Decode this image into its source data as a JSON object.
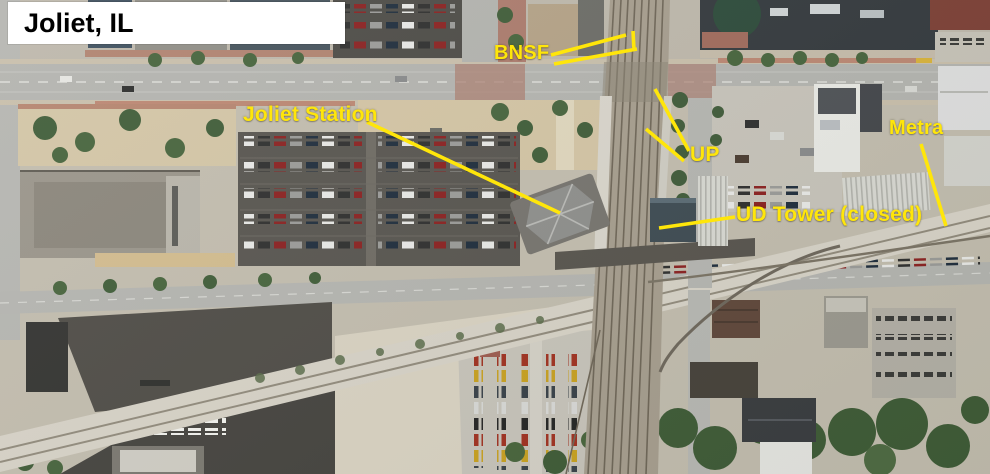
{
  "image": {
    "width": 990,
    "height": 474,
    "kind": "annotated aerial photo of downtown Joliet"
  },
  "title_box": {
    "text": "Joliet, IL"
  },
  "labels": {
    "bnsf": "BNSF",
    "joliet_station": "Joliet Station",
    "up": "UP",
    "ud_tower": "UD Tower (closed)",
    "metra": "Metra"
  },
  "colors": {
    "annotation": "#ffe60a",
    "title_text": "#000000",
    "title_background": "#ffffff"
  }
}
